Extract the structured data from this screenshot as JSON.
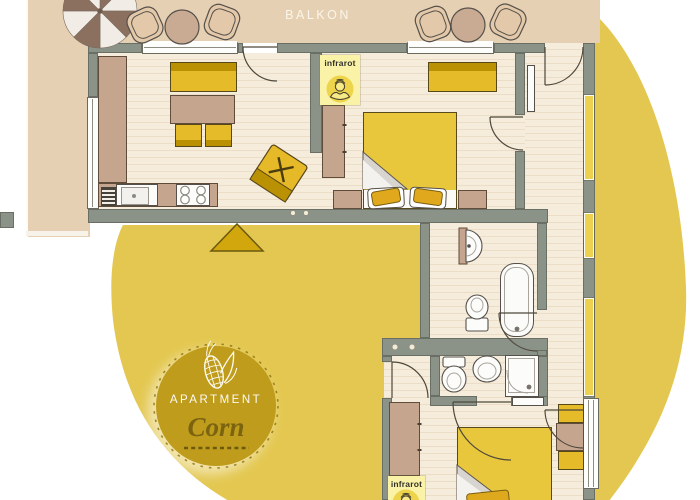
{
  "balcony": {
    "label": "BALKON"
  },
  "badge": {
    "kicker": "APARTMENT",
    "name": "Corn"
  },
  "sauna_badges": [
    {
      "label": "infrarot"
    },
    {
      "label": "infrarot"
    }
  ],
  "colors": {
    "background_circle": "#e3c750",
    "badge_gold": "#bf9c1c",
    "badge_name_text": "#7b6410",
    "wall": "#8b9288",
    "balcony": "#e6d0b3",
    "floor": "#f6ecdc",
    "furniture_yellow": "#e6bb2a",
    "furniture_brown": "#c6a58e",
    "sauna_badge_bg": "#faf2a7"
  },
  "icons": {
    "parasol": "parasol-icon",
    "corn": "corn-cob-icon",
    "sauna": "person-sauna-icon",
    "arrow": "triangle-arrow-icon"
  }
}
